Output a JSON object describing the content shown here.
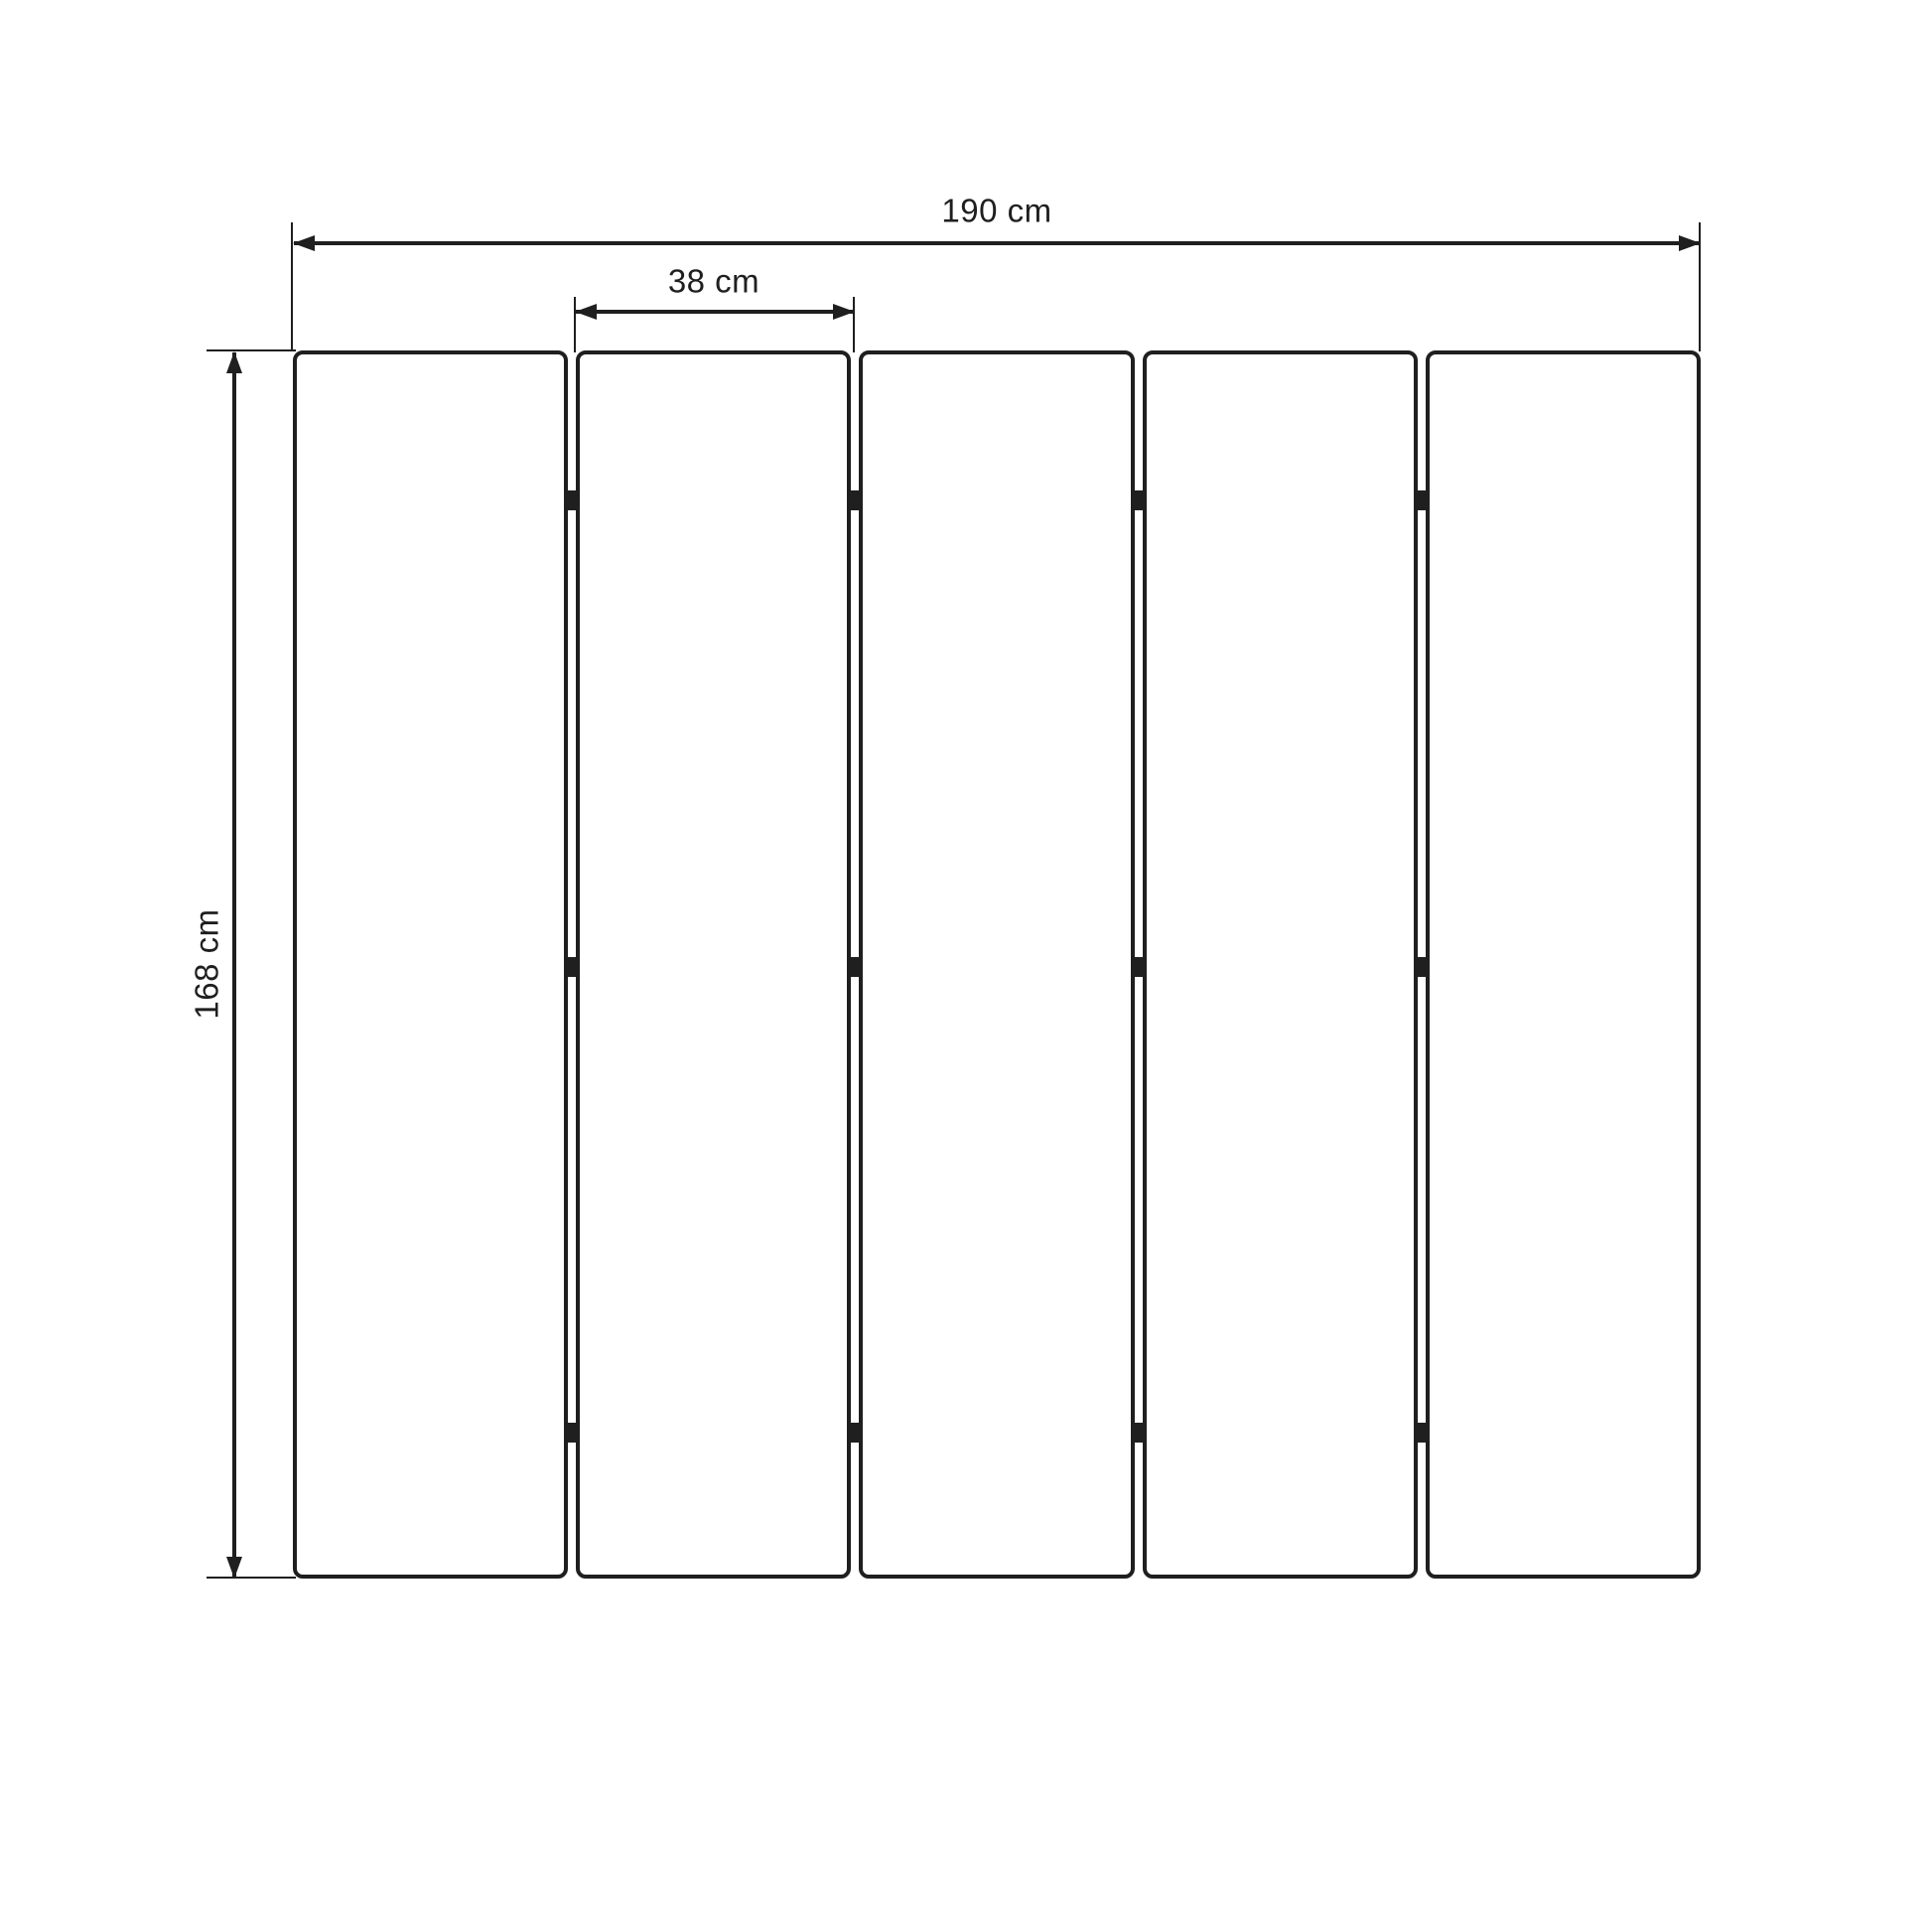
{
  "diagram": {
    "type": "technical-drawing",
    "dimensions": {
      "total_width": {
        "label": "190 cm",
        "value": 190,
        "unit": "cm"
      },
      "panel_width": {
        "label": "38 cm",
        "value": 38,
        "unit": "cm"
      },
      "height": {
        "label": "168 cm",
        "value": 168,
        "unit": "cm"
      }
    },
    "panels": {
      "count": 5,
      "joints": 4,
      "hinges_per_joint": 3
    },
    "colors": {
      "line": "#1f1f1f",
      "background": "#ffffff"
    }
  }
}
